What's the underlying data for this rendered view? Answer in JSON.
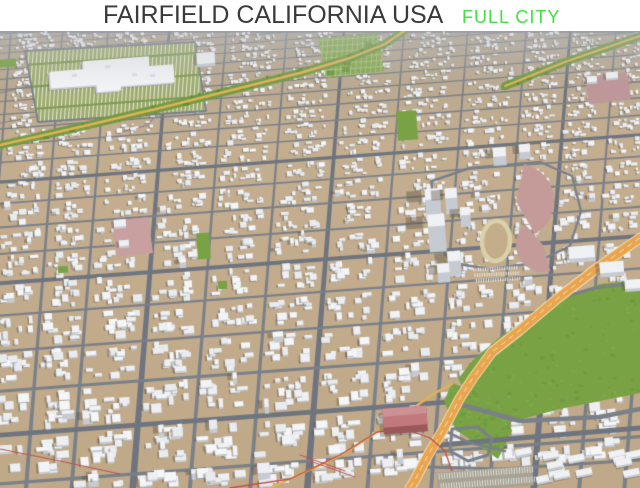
{
  "header": {
    "title": "FAIRFIELD CALIFORNIA USA",
    "subtitle": "FULL CITY",
    "title_color": "#3a3a3c",
    "subtitle_color": "#3fe23f",
    "background": "#ffffff"
  },
  "scene": {
    "description": "3D aerial oblique render of the full city of Fairfield, California: dense white low-poly buildings on tan ground, gray street grid, green parks, an orange freeway with interchange, red rail lines, a shopping mall with striped parking, and a school stadium with running track",
    "palette": {
      "ground": "#c4ae90",
      "ground_far": "#b2a692",
      "ground_low": "#c0a988",
      "road": "#7a8089",
      "road_major": "#6e757f",
      "building_top": "#eff1f4",
      "building_side": "#c6cbd2",
      "building_shadow": "rgba(92,84,66,0.42)",
      "park": "#78a244",
      "park_dark": "#618e36",
      "tree": "#5f8c38",
      "garden": "#84a94f",
      "garden_line": "#b5c489",
      "parking_lot": "#9cab6d",
      "parking_stripe": "rgba(238,238,228,0.85)",
      "highway": "#e9a44d",
      "highway_edge": "#f3ddb0",
      "trunk_road": "#e2b257",
      "railway": "#c14f48",
      "sports_ground": "#c49b99",
      "school_ground": "#c9a0a0",
      "track_ring": "#dbd0a8",
      "track_infield": "#c3ad8b",
      "landmark_roof": "#c2797d",
      "landmark_front": "#9c575b",
      "haze": "rgba(190,193,200,0.45)"
    },
    "landmarks": [
      {
        "name": "shopping-mall",
        "kind": "large flat white building with tree-striped parking"
      },
      {
        "name": "community-garden",
        "kind": "green allotment grid"
      },
      {
        "name": "school-stadium",
        "kind": "running track with red sports fields"
      },
      {
        "name": "downtown-towers",
        "kind": "cluster of tall white buildings"
      },
      {
        "name": "city-park",
        "kind": "large green field beside the freeway"
      },
      {
        "name": "freeway",
        "kind": "orange diagonal highway with interchange ramps"
      },
      {
        "name": "railway",
        "kind": "thin red rail lines"
      },
      {
        "name": "red-warehouse",
        "kind": "large red industrial building"
      }
    ]
  }
}
